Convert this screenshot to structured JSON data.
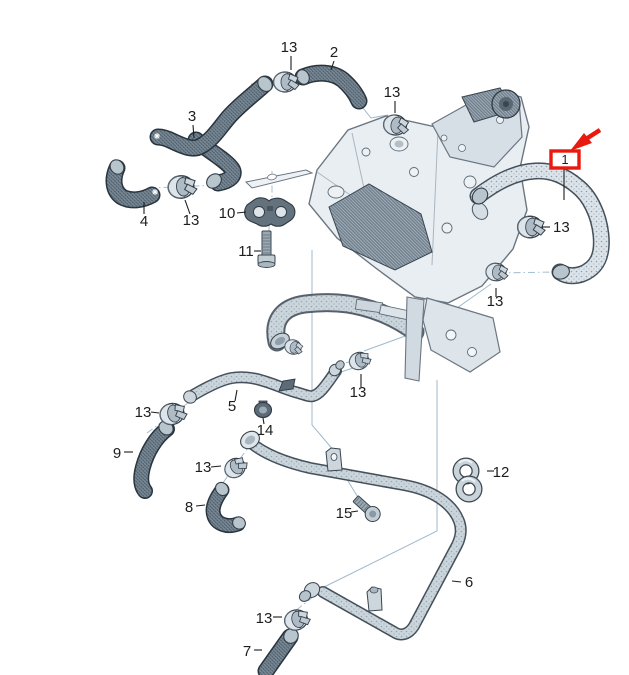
{
  "diagram": {
    "background_color": "#ffffff",
    "callout_text_color": "#1d1d1b",
    "assembly_line_color": "#9fb9cc",
    "highlight_color": "#e8190f",
    "hose_dark_color": "#53626e",
    "pipe_light_color": "#cbd5dc"
  },
  "labels": {
    "part1": "1",
    "part2": "2",
    "part3": "3",
    "part4": "4",
    "part5": "5",
    "part6": "6",
    "part7": "7",
    "part8": "8",
    "part9": "9",
    "part10": "10",
    "part11": "11",
    "part12": "12",
    "part13": "13",
    "part14": "14",
    "part15": "15"
  }
}
